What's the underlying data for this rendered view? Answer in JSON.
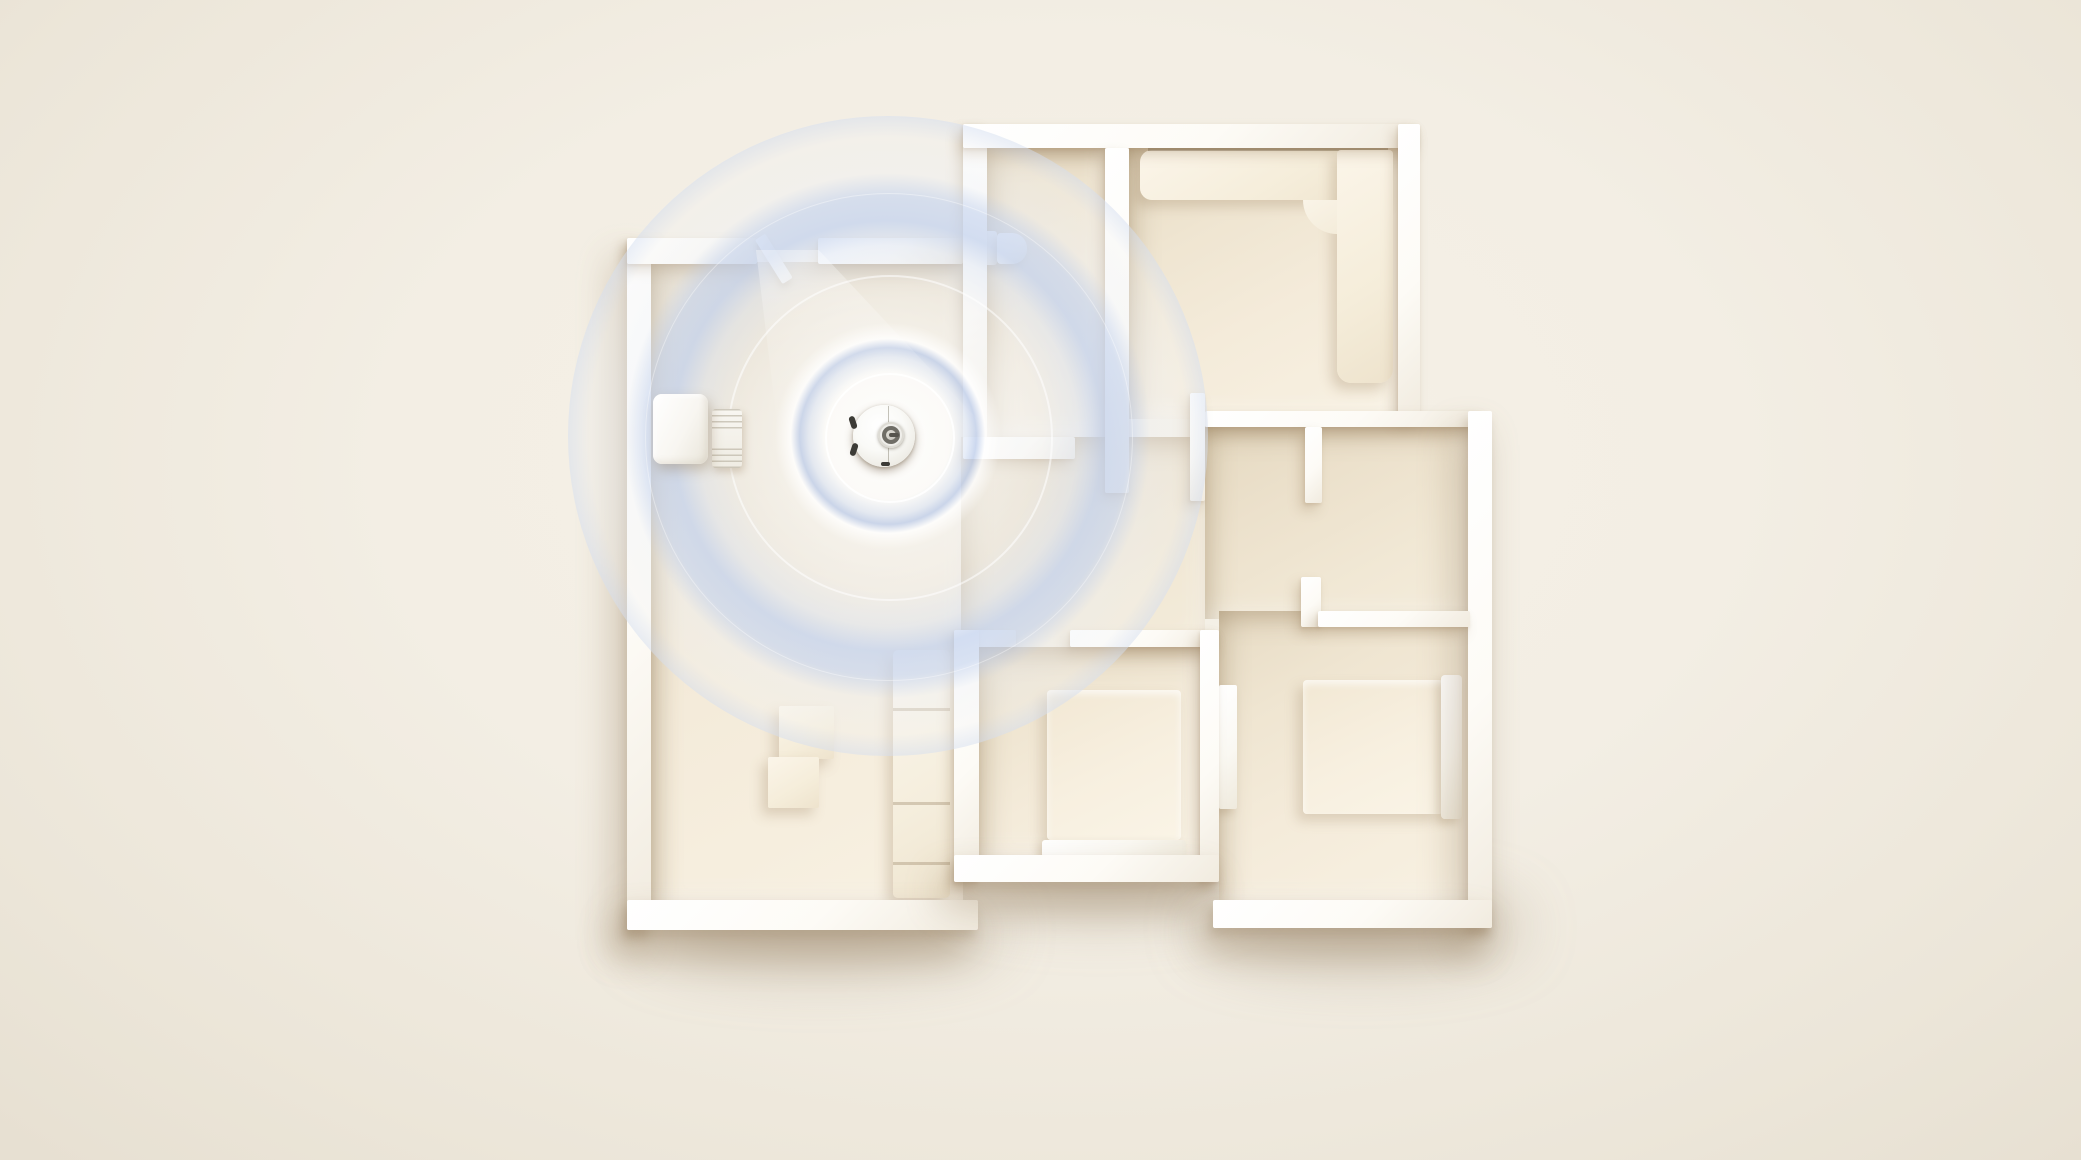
{
  "scene": {
    "label": "3d-apartment-floorplan-with-robot-vacuum-lidar-mapping",
    "canvas": {
      "width": 2081,
      "height": 1160
    },
    "colors": {
      "background": "#f3eee4",
      "background_edge": "#e7e0d2",
      "wall_white": "#fdfbf6",
      "floor_cream": "#f4ebda",
      "floor_shade": "#e7dbc4",
      "radar_blue": "#c6d3ee",
      "robot_white": "#ffffff",
      "lidar_dark": "#6f6d66",
      "shadow_warm": "rgba(148,124,92,0.45)"
    }
  },
  "plan": {
    "ground_shadows": [
      {
        "name": "plan-ground-shadow-left",
        "x": 640,
        "y": 896,
        "w": 360,
        "h": 70
      },
      {
        "name": "plan-ground-shadow-mid",
        "x": 960,
        "y": 850,
        "w": 280,
        "h": 60
      },
      {
        "name": "plan-ground-shadow-right",
        "x": 1200,
        "y": 892,
        "w": 320,
        "h": 70
      }
    ],
    "floors": [
      {
        "name": "living-room-floor",
        "x": 651,
        "y": 262,
        "w": 312,
        "h": 640
      },
      {
        "name": "bathroom-floor",
        "x": 987,
        "y": 148,
        "w": 118,
        "h": 289
      },
      {
        "name": "lounge-floor",
        "x": 1129,
        "y": 148,
        "w": 269,
        "h": 271
      },
      {
        "name": "hallway-floor",
        "x": 961,
        "y": 437,
        "w": 244,
        "h": 212
      },
      {
        "name": "study-floor",
        "x": 1205,
        "y": 427,
        "w": 263,
        "h": 192
      },
      {
        "name": "bedroom1-floor",
        "x": 979,
        "y": 647,
        "w": 221,
        "h": 210
      },
      {
        "name": "bedroom2-floor",
        "x": 1219,
        "y": 611,
        "w": 249,
        "h": 291
      }
    ],
    "walls": [
      {
        "name": "living-room-left-wall",
        "x": 627,
        "y": 238,
        "w": 24,
        "h": 692,
        "heavy": true
      },
      {
        "name": "living-room-bottom-wall",
        "x": 627,
        "y": 900,
        "w": 351,
        "h": 30,
        "heavy": true
      },
      {
        "name": "living-room-top-wall-left",
        "x": 627,
        "y": 238,
        "w": 130,
        "h": 26
      },
      {
        "name": "living-room-top-wall-right",
        "x": 818,
        "y": 238,
        "w": 145,
        "h": 26
      },
      {
        "name": "bathroom-left-wall",
        "x": 963,
        "y": 124,
        "w": 24,
        "h": 335
      },
      {
        "name": "top-outer-wall",
        "x": 963,
        "y": 124,
        "w": 457,
        "h": 24
      },
      {
        "name": "bathroom-bottom-wall",
        "x": 963,
        "y": 437,
        "w": 112,
        "h": 22
      },
      {
        "name": "bathroom-lounge-divider-wall",
        "x": 1105,
        "y": 148,
        "w": 24,
        "h": 345
      },
      {
        "name": "lounge-right-wall",
        "x": 1398,
        "y": 124,
        "w": 22,
        "h": 295
      },
      {
        "name": "study-top-wall",
        "x": 1205,
        "y": 411,
        "w": 278,
        "h": 16
      },
      {
        "name": "right-outer-wall",
        "x": 1468,
        "y": 411,
        "w": 24,
        "h": 517,
        "heavy": true
      },
      {
        "name": "hall-stub-wall",
        "x": 1190,
        "y": 393,
        "w": 15,
        "h": 108
      },
      {
        "name": "study-divider-wall",
        "x": 1305,
        "y": 427,
        "w": 17,
        "h": 76
      },
      {
        "name": "bedroom2-door-stub-wall",
        "x": 1301,
        "y": 577,
        "w": 20,
        "h": 50
      },
      {
        "name": "bedroom2-top-wall",
        "x": 1318,
        "y": 611,
        "w": 152,
        "h": 16
      },
      {
        "name": "bedroom1-top-wall-left",
        "x": 954,
        "y": 630,
        "w": 62,
        "h": 17
      },
      {
        "name": "bedroom1-top-wall-right",
        "x": 1070,
        "y": 630,
        "w": 149,
        "h": 17
      },
      {
        "name": "bedroom1-left-wall",
        "x": 954,
        "y": 630,
        "w": 25,
        "h": 252
      },
      {
        "name": "bedroom-shared-wall",
        "x": 1200,
        "y": 630,
        "w": 19,
        "h": 252
      },
      {
        "name": "bedroom1-bottom-wall",
        "x": 954,
        "y": 855,
        "w": 265,
        "h": 27,
        "heavy": true
      },
      {
        "name": "bedroom2-bottom-wall",
        "x": 1213,
        "y": 900,
        "w": 279,
        "h": 28,
        "heavy": true
      }
    ],
    "door_cap": {
      "name": "entry-door-cap",
      "x": 755,
      "y": 240,
      "w": 12,
      "h": 52,
      "rotate": -32
    },
    "furniture": [
      {
        "name": "lounge-sofa-top",
        "x": 1140,
        "y": 150,
        "w": 253,
        "h": 50,
        "r": "12px 4px 4px 12px"
      },
      {
        "name": "lounge-sofa-gap-line",
        "x": 1148,
        "y": 148,
        "w": 240,
        "h": 3,
        "flat": true,
        "color": "rgba(105,88,62,0.45)"
      },
      {
        "name": "lounge-sofa-side",
        "x": 1337,
        "y": 150,
        "w": 56,
        "h": 233,
        "r": "4px 4px 14px 14px"
      },
      {
        "name": "lounge-sofa-corner-fillet",
        "x": 1303,
        "y": 200,
        "w": 34,
        "h": 34,
        "r": "0 0 0 100%",
        "fillet": true
      },
      {
        "name": "toilet-tank",
        "x": 982,
        "y": 231,
        "w": 15,
        "h": 34,
        "r": "3px",
        "bright": true
      },
      {
        "name": "toilet-bowl",
        "x": 997,
        "y": 233,
        "w": 30,
        "h": 31,
        "r": "4px 15px 15px 4px",
        "bright": true
      },
      {
        "name": "living-room-sofa",
        "x": 893,
        "y": 650,
        "w": 57,
        "h": 248,
        "r": "5px"
      },
      {
        "name": "coffee-table-1",
        "x": 779,
        "y": 706,
        "w": 55,
        "h": 53,
        "r": "2px"
      },
      {
        "name": "coffee-table-2",
        "x": 768,
        "y": 757,
        "w": 51,
        "h": 51,
        "r": "2px"
      },
      {
        "name": "bedroom1-bed",
        "x": 1047,
        "y": 690,
        "w": 134,
        "h": 150,
        "r": "4px"
      },
      {
        "name": "bedroom1-bed-footboard",
        "x": 1042,
        "y": 840,
        "w": 144,
        "h": 17,
        "r": "3px",
        "bright": true
      },
      {
        "name": "bedroom2-bed",
        "x": 1303,
        "y": 680,
        "w": 140,
        "h": 134,
        "r": "4px"
      },
      {
        "name": "bedroom2-bed-headboard",
        "x": 1441,
        "y": 675,
        "w": 21,
        "h": 144,
        "r": "4px",
        "bright": true
      },
      {
        "name": "bedroom2-wardrobe",
        "x": 1219,
        "y": 685,
        "w": 18,
        "h": 124,
        "r": "2px",
        "bright": true
      }
    ]
  },
  "radar": {
    "cx": 888,
    "cy": 436,
    "outer_radius": 320,
    "rings": [
      {
        "name": "radar-ring-inner",
        "radius": 63,
        "border": "2.5px solid rgba(255,255,255,0.85)"
      },
      {
        "name": "radar-ring-middle",
        "radius": 161,
        "border": "2px solid rgba(255,255,255,0.55)"
      },
      {
        "name": "radar-ring-outer",
        "radius": 243,
        "border": "1.5px solid rgba(255,255,255,0.38)"
      }
    ]
  },
  "beam": {
    "name": "lidar-light-beam",
    "x": 690,
    "y": 250,
    "w": 330,
    "h": 190,
    "polygon": "polygon(20% 0, 39% 0, 93% 100%, 27% 100%)"
  },
  "dock": {
    "station": {
      "name": "dock-station",
      "x": 653,
      "y": 394,
      "w": 55,
      "h": 70
    },
    "pad": {
      "name": "dock-pad",
      "x": 712,
      "y": 409,
      "w": 30,
      "h": 59
    }
  },
  "robot": {
    "cx": 884,
    "cy": 436,
    "radius": 31,
    "lidar": {
      "cx": 891,
      "cy": 435,
      "radius": 13
    },
    "seam_offset": 0.56,
    "bumpers": [
      {
        "x": -3,
        "y": 11,
        "w": 6,
        "h": 13,
        "rotate": -18
      },
      {
        "x": -2,
        "y": 38,
        "w": 6,
        "h": 13,
        "rotate": 18
      },
      {
        "x": 28,
        "y": 57,
        "w": 9,
        "h": 4,
        "rotate": 0
      }
    ]
  }
}
